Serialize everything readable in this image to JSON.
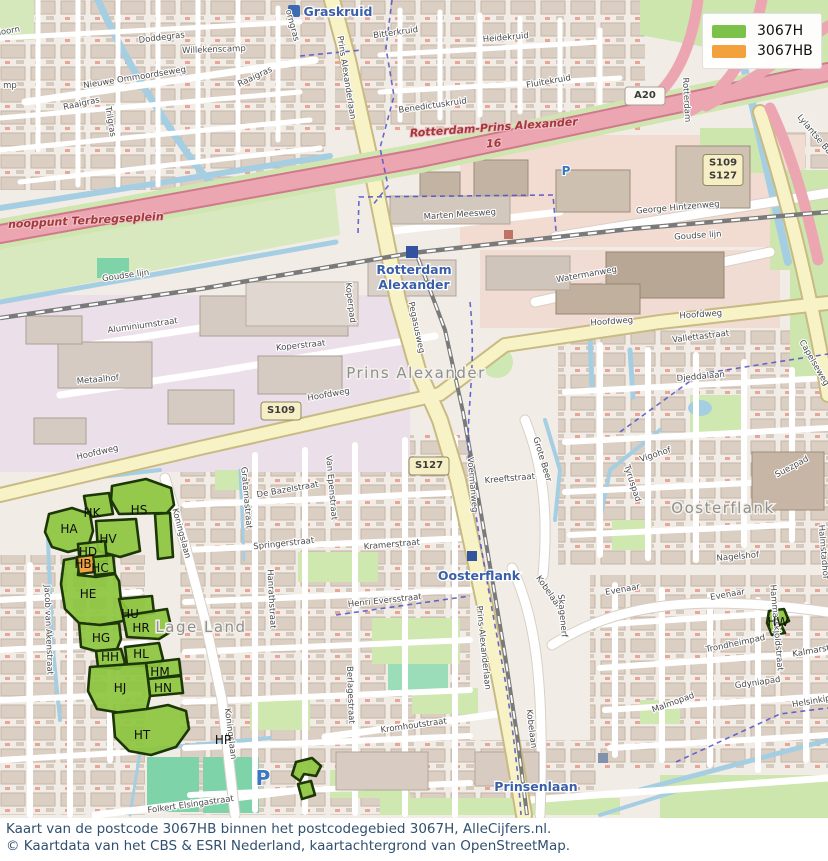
{
  "legend": {
    "items": [
      {
        "label": "3067H",
        "color": "#7CC24A"
      },
      {
        "label": "3067HB",
        "color": "#F2A13C"
      }
    ]
  },
  "caption": {
    "line1": "Kaart van de postcode 3067HB binnen het postcodegebied 3067H, AlleCijfers.nl.",
    "line2": "© Kaartdata van het CBS & ESRI Nederland, kaartachtergrond van OpenStreetMap."
  },
  "map": {
    "colors": {
      "postcode_area_green": "#8CC63E",
      "postcode_selected_orange": "#F2A13C",
      "station_blue": "#3A5FA8",
      "motorway_label_red": "#A03A3C"
    },
    "area_labels": [
      {
        "text": "Prins Alexander",
        "x": 416,
        "y": 378
      },
      {
        "text": "Oosterflank",
        "x": 723,
        "y": 513
      },
      {
        "text": "Lage Land",
        "x": 201,
        "y": 632
      }
    ],
    "station_labels": [
      {
        "text": "Graskruid",
        "x": 338,
        "y": 16
      },
      {
        "text": "Rotterdam",
        "x": 414,
        "y": 274
      },
      {
        "text": "Alexander",
        "x": 414,
        "y": 289
      },
      {
        "text": "Oosterflank",
        "x": 479,
        "y": 580
      },
      {
        "text": "Prinsenlaan",
        "x": 536,
        "y": 791
      }
    ],
    "motorway_labels": [
      {
        "text": "Rotterdam-Prins Alexander",
        "x": 494,
        "y": 131,
        "rot": -4
      },
      {
        "text": "16",
        "x": 494,
        "y": 147,
        "rot": -4
      },
      {
        "text": "nooppunt Terbregseplein",
        "x": 86,
        "y": 224,
        "rot": -3
      }
    ],
    "street_labels": [
      {
        "text": "sdoorn",
        "x": 6,
        "y": 34,
        "rot": -10
      },
      {
        "text": "mp",
        "x": 10,
        "y": 88,
        "rot": 0
      },
      {
        "text": "Doddegras",
        "x": 162,
        "y": 40,
        "rot": -7
      },
      {
        "text": "Willekenscamp",
        "x": 214,
        "y": 52,
        "rot": -2
      },
      {
        "text": "Nieuwe Ommoordseweg",
        "x": 135,
        "y": 80,
        "rot": -9
      },
      {
        "text": "Raaigras",
        "x": 82,
        "y": 106,
        "rot": -12
      },
      {
        "text": "Raaigras",
        "x": 256,
        "y": 79,
        "rot": -25
      },
      {
        "text": "Trilgras",
        "x": 108,
        "y": 122,
        "rot": 80
      },
      {
        "text": "orngras",
        "x": 290,
        "y": 26,
        "rot": 75
      },
      {
        "text": "Bitterkruid",
        "x": 396,
        "y": 35,
        "rot": -8
      },
      {
        "text": "Heidekruid",
        "x": 506,
        "y": 40,
        "rot": -5
      },
      {
        "text": "Fluitekruid",
        "x": 549,
        "y": 84,
        "rot": -10
      },
      {
        "text": "Benedictuskruid",
        "x": 433,
        "y": 108,
        "rot": -8
      },
      {
        "text": "Lylantse Baan",
        "x": 816,
        "y": 140,
        "rot": 50
      },
      {
        "text": "Rotterdam",
        "x": 684,
        "y": 100,
        "rot": 87
      },
      {
        "text": "Prins Alexanderlaan",
        "x": 344,
        "y": 78,
        "rot": 81
      },
      {
        "text": "Prins Alexanderlaan",
        "x": 481,
        "y": 648,
        "rot": 84
      },
      {
        "text": "Goudse lijn",
        "x": 126,
        "y": 278,
        "rot": -8
      },
      {
        "text": "Goudse lijn",
        "x": 698,
        "y": 238,
        "rot": -4
      },
      {
        "text": "George Hintzenweg",
        "x": 678,
        "y": 210,
        "rot": -5
      },
      {
        "text": "Marten Meesweg",
        "x": 460,
        "y": 217,
        "rot": -4
      },
      {
        "text": "Watermanweg",
        "x": 587,
        "y": 277,
        "rot": -10
      },
      {
        "text": "Koperpad",
        "x": 348,
        "y": 303,
        "rot": 83
      },
      {
        "text": "Pegasusweg",
        "x": 414,
        "y": 328,
        "rot": 78
      },
      {
        "text": "Aluminiumstraat",
        "x": 143,
        "y": 328,
        "rot": -8
      },
      {
        "text": "Koperstraat",
        "x": 301,
        "y": 348,
        "rot": -6
      },
      {
        "text": "Metaalhof",
        "x": 98,
        "y": 382,
        "rot": -5
      },
      {
        "text": "Hoofdweg",
        "x": 98,
        "y": 455,
        "rot": -13
      },
      {
        "text": "Hoofdweg",
        "x": 329,
        "y": 397,
        "rot": -10
      },
      {
        "text": "Hoofdweg",
        "x": 612,
        "y": 324,
        "rot": -4
      },
      {
        "text": "Hoofdweg",
        "x": 701,
        "y": 317,
        "rot": -4
      },
      {
        "text": "Vallettastraat",
        "x": 701,
        "y": 339,
        "rot": -7
      },
      {
        "text": "Djeddalaan",
        "x": 701,
        "y": 379,
        "rot": -5
      },
      {
        "text": "Capelseweg",
        "x": 812,
        "y": 364,
        "rot": 60
      },
      {
        "text": "Grote Beer",
        "x": 540,
        "y": 460,
        "rot": 73
      },
      {
        "text": "Kreeftstraat",
        "x": 510,
        "y": 481,
        "rot": -5
      },
      {
        "text": "Voermanweg",
        "x": 470,
        "y": 485,
        "rot": 85
      },
      {
        "text": "Vigohof",
        "x": 656,
        "y": 457,
        "rot": -18
      },
      {
        "text": "Tyruspad",
        "x": 630,
        "y": 484,
        "rot": 72
      },
      {
        "text": "Suezpad",
        "x": 793,
        "y": 469,
        "rot": -28
      },
      {
        "text": "Nagelshof",
        "x": 738,
        "y": 559,
        "rot": -5
      },
      {
        "text": "Halmstadhof",
        "x": 821,
        "y": 552,
        "rot": 85
      },
      {
        "text": "Gratamastraat",
        "x": 244,
        "y": 498,
        "rot": 85
      },
      {
        "text": "De Bazelstraat",
        "x": 288,
        "y": 492,
        "rot": -10
      },
      {
        "text": "Van Epenstraat",
        "x": 329,
        "y": 488,
        "rot": 85
      },
      {
        "text": "Springerstraat",
        "x": 284,
        "y": 546,
        "rot": -6
      },
      {
        "text": "Kramerstraat",
        "x": 392,
        "y": 547,
        "rot": -5
      },
      {
        "text": "Hanrathstraat",
        "x": 269,
        "y": 599,
        "rot": 87
      },
      {
        "text": "Henri Eversstraat",
        "x": 385,
        "y": 603,
        "rot": -6
      },
      {
        "text": "Koningslaan",
        "x": 179,
        "y": 534,
        "rot": 75
      },
      {
        "text": "Koningslaan",
        "x": 228,
        "y": 734,
        "rot": 83
      },
      {
        "text": "Jacob van Akenstraat",
        "x": 46,
        "y": 630,
        "rot": 88
      },
      {
        "text": "Evenaar",
        "x": 623,
        "y": 592,
        "rot": -10
      },
      {
        "text": "Evenaar",
        "x": 728,
        "y": 597,
        "rot": -10
      },
      {
        "text": "Kobelaan",
        "x": 547,
        "y": 594,
        "rot": 55
      },
      {
        "text": "Kobelaan",
        "x": 529,
        "y": 729,
        "rot": 83
      },
      {
        "text": "Skagenerf",
        "x": 560,
        "y": 616,
        "rot": 85
      },
      {
        "text": "Hammarskjoldstraat",
        "x": 774,
        "y": 628,
        "rot": 85
      },
      {
        "text": "Trondheimpad",
        "x": 736,
        "y": 646,
        "rot": -12
      },
      {
        "text": "Kalmarstraat",
        "x": 820,
        "y": 652,
        "rot": -10
      },
      {
        "text": "Gdyniapad",
        "x": 758,
        "y": 685,
        "rot": -8
      },
      {
        "text": "Malmopad",
        "x": 674,
        "y": 705,
        "rot": -20
      },
      {
        "text": "Helsinkipad",
        "x": 817,
        "y": 703,
        "rot": -10
      },
      {
        "text": "Kromhoutstraat",
        "x": 414,
        "y": 728,
        "rot": -8
      },
      {
        "text": "Berlagestraat",
        "x": 348,
        "y": 695,
        "rot": 88
      },
      {
        "text": "Folkert Elsingastraat",
        "x": 191,
        "y": 807,
        "rot": -8
      }
    ],
    "postcode_labels": [
      {
        "text": "HA",
        "x": 69,
        "y": 533
      },
      {
        "text": "HK",
        "x": 92,
        "y": 517
      },
      {
        "text": "HS",
        "x": 139,
        "y": 514
      },
      {
        "text": "HV",
        "x": 108,
        "y": 543
      },
      {
        "text": "HD",
        "x": 88,
        "y": 556
      },
      {
        "text": "HB",
        "x": 83,
        "y": 568
      },
      {
        "text": "HC",
        "x": 100,
        "y": 572
      },
      {
        "text": "HE",
        "x": 88,
        "y": 598
      },
      {
        "text": "HU",
        "x": 130,
        "y": 618
      },
      {
        "text": "HR",
        "x": 141,
        "y": 632
      },
      {
        "text": "HG",
        "x": 101,
        "y": 642
      },
      {
        "text": "HH",
        "x": 110,
        "y": 661
      },
      {
        "text": "HL",
        "x": 141,
        "y": 658
      },
      {
        "text": "HM",
        "x": 160,
        "y": 676
      },
      {
        "text": "HN",
        "x": 163,
        "y": 692
      },
      {
        "text": "HJ",
        "x": 120,
        "y": 692
      },
      {
        "text": "HT",
        "x": 142,
        "y": 739
      },
      {
        "text": "HP",
        "x": 223,
        "y": 744
      },
      {
        "text": "HW",
        "x": 778,
        "y": 626
      }
    ],
    "road_badges": [
      {
        "type": "motorway",
        "lines": [
          "A20"
        ],
        "x": 645,
        "y": 96
      },
      {
        "type": "provincial",
        "lines": [
          "S109",
          "S127"
        ],
        "x": 723,
        "y": 170
      },
      {
        "type": "provincial",
        "lines": [
          "S109"
        ],
        "x": 281,
        "y": 411
      },
      {
        "type": "provincial",
        "lines": [
          "S127"
        ],
        "x": 429,
        "y": 466
      }
    ],
    "parking_icons": [
      {
        "x": 263,
        "y": 785,
        "size": 20
      },
      {
        "x": 566,
        "y": 175,
        "size": 12
      }
    ]
  }
}
